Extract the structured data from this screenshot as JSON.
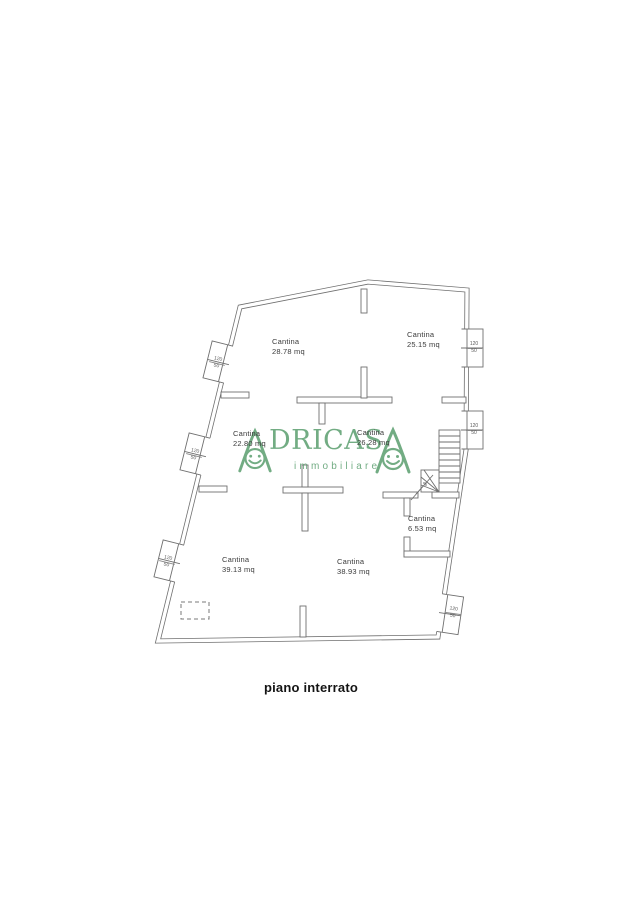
{
  "document": {
    "caption": "piano interrato"
  },
  "watermark": {
    "brand": "ADRICASA",
    "brand_middle_letters": "DRICAS",
    "tagline": "immobiliare",
    "color": "#5fa173"
  },
  "plan": {
    "line_color": "#6f6f6f",
    "label_color": "#3b3b3b",
    "rooms": [
      {
        "name": "Cantina",
        "area": "28.78 mq"
      },
      {
        "name": "Cantina",
        "area": "25.15 mq"
      },
      {
        "name": "Cantina",
        "area": "22.80 mq"
      },
      {
        "name": "Cantina",
        "area": "26.28 mq"
      },
      {
        "name": "Cantina",
        "area": "6.53 mq"
      },
      {
        "name": "Cantina",
        "area": "39.13 mq"
      },
      {
        "name": "Cantina",
        "area": "38.93 mq"
      }
    ],
    "windows": [
      {
        "label_top": "120",
        "label_bottom": "50"
      },
      {
        "label_top": "120",
        "label_bottom": "50"
      },
      {
        "label_top": "120",
        "label_bottom": "50"
      },
      {
        "label_top": "120",
        "label_bottom": "50"
      },
      {
        "label_top": "120",
        "label_bottom": "50"
      },
      {
        "label_top": "120",
        "label_bottom": "50"
      }
    ]
  }
}
